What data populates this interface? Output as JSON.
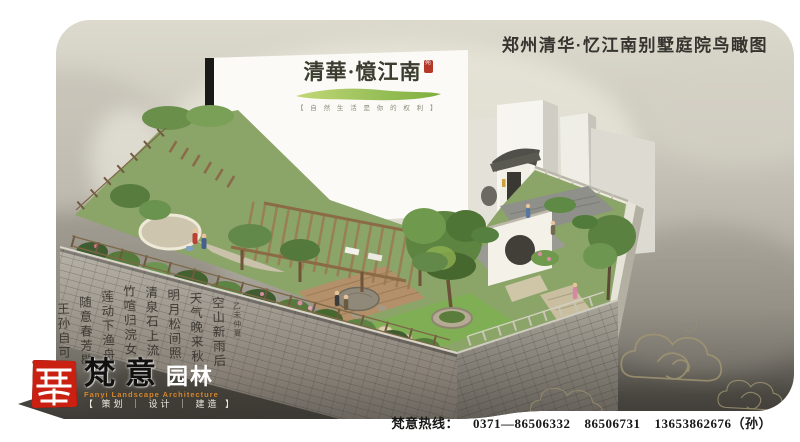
{
  "header": {
    "title": "郑州清华·忆江南别墅庭院鸟瞰图"
  },
  "building_logo": {
    "brand": "清華·憶江南",
    "seal_mark": "苑",
    "tagline": "【 自 然 生 活 是 你 的 权 利 】",
    "stroke_color_light": "#c3d878",
    "stroke_color_dark": "#7fae3f"
  },
  "calligraphy": {
    "signature": "乙未仲夏",
    "columns": [
      "空山新雨后",
      "天气晚来秋",
      "明月松间照",
      "清泉石上流",
      "竹喧归浣女",
      "莲动下渔舟",
      "随意春芳歇",
      "王孙自可留"
    ]
  },
  "company": {
    "name_script": "梵意",
    "name_block": "园林",
    "english": "Fanyi Landscape Architecture",
    "services": "【 策划 ｜ 设计 ｜ 建造 】",
    "seal_color": "#c92012"
  },
  "contact": {
    "label": "梵意热线：",
    "phone1": "0371—86506332",
    "phone2": "86506731",
    "phone3": "13653862676（孙）"
  },
  "scene": {
    "description": "bird-eye rendering of villa courtyard garden",
    "accent_cloud_color": "#a29672",
    "panel_top_color": "#dcd9cd",
    "panel_bottom_color": "#3e3b37"
  }
}
